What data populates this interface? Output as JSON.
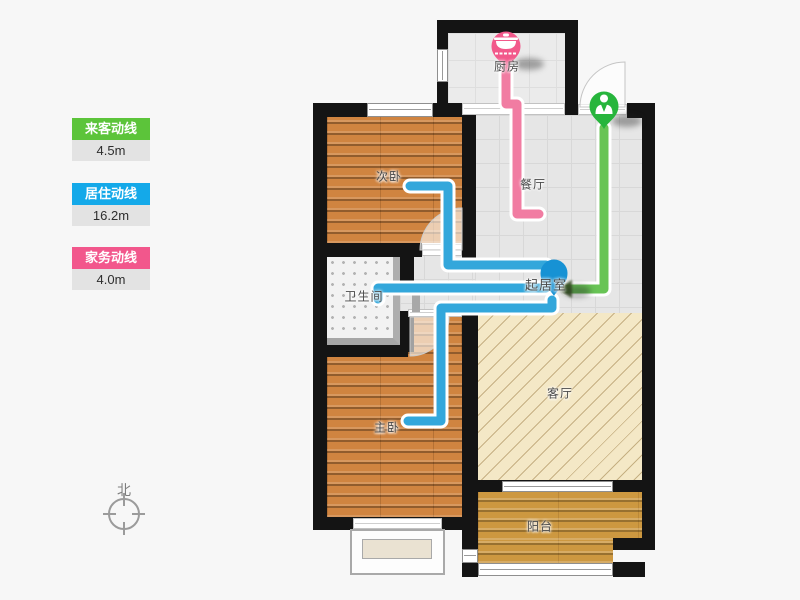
{
  "legend": {
    "items": [
      {
        "id": "guest",
        "label": "来客动线",
        "value": "4.5m",
        "color": "#5cc43a"
      },
      {
        "id": "resident",
        "label": "居住动线",
        "value": "16.2m",
        "color": "#14a9e9"
      },
      {
        "id": "chore",
        "label": "家务动线",
        "value": "4.0m",
        "color": "#f2578c"
      }
    ]
  },
  "compass": {
    "label": "北"
  },
  "plan": {
    "rooms": [
      {
        "id": "kitchen",
        "label": "厨房"
      },
      {
        "id": "dining",
        "label": "餐厅"
      },
      {
        "id": "bedroom2",
        "label": "次卧"
      },
      {
        "id": "hall",
        "label": "起居室"
      },
      {
        "id": "bathroom",
        "label": "卫生间"
      },
      {
        "id": "master-bedroom",
        "label": "主卧"
      },
      {
        "id": "living-room",
        "label": "客厅"
      },
      {
        "id": "balcony",
        "label": "阳台"
      }
    ],
    "routes": [
      {
        "id": "guest",
        "color": "#68c455",
        "marker_icon": "person-icon",
        "marker_room": "entrance"
      },
      {
        "id": "resident",
        "color": "#33a7db",
        "marker_icon": "pin-icon",
        "marker_room": "起居室"
      },
      {
        "id": "chore",
        "color": "#f17ca2",
        "marker_icon": "pot-icon",
        "marker_room": "厨房"
      }
    ]
  }
}
